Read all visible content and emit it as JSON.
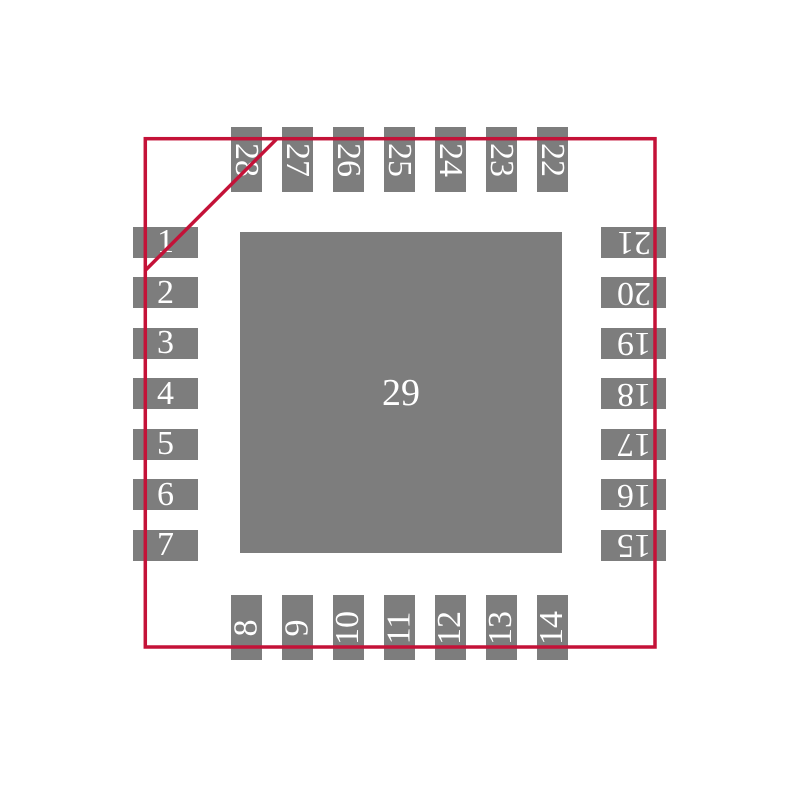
{
  "colors": {
    "outline": "#c41238",
    "pad": "#7d7d7d",
    "pad_label": "#ffffff",
    "background": "#ffffff"
  },
  "footprint": {
    "center": "29",
    "left": [
      "1",
      "2",
      "3",
      "4",
      "5",
      "6",
      "7"
    ],
    "bottom": [
      "8",
      "9",
      "10",
      "11",
      "12",
      "13",
      "14"
    ],
    "right_ttb": [
      "21",
      "20",
      "19",
      "18",
      "17",
      "16",
      "15"
    ],
    "top_ltr": [
      "28",
      "27",
      "26",
      "25",
      "24",
      "23",
      "22"
    ]
  }
}
